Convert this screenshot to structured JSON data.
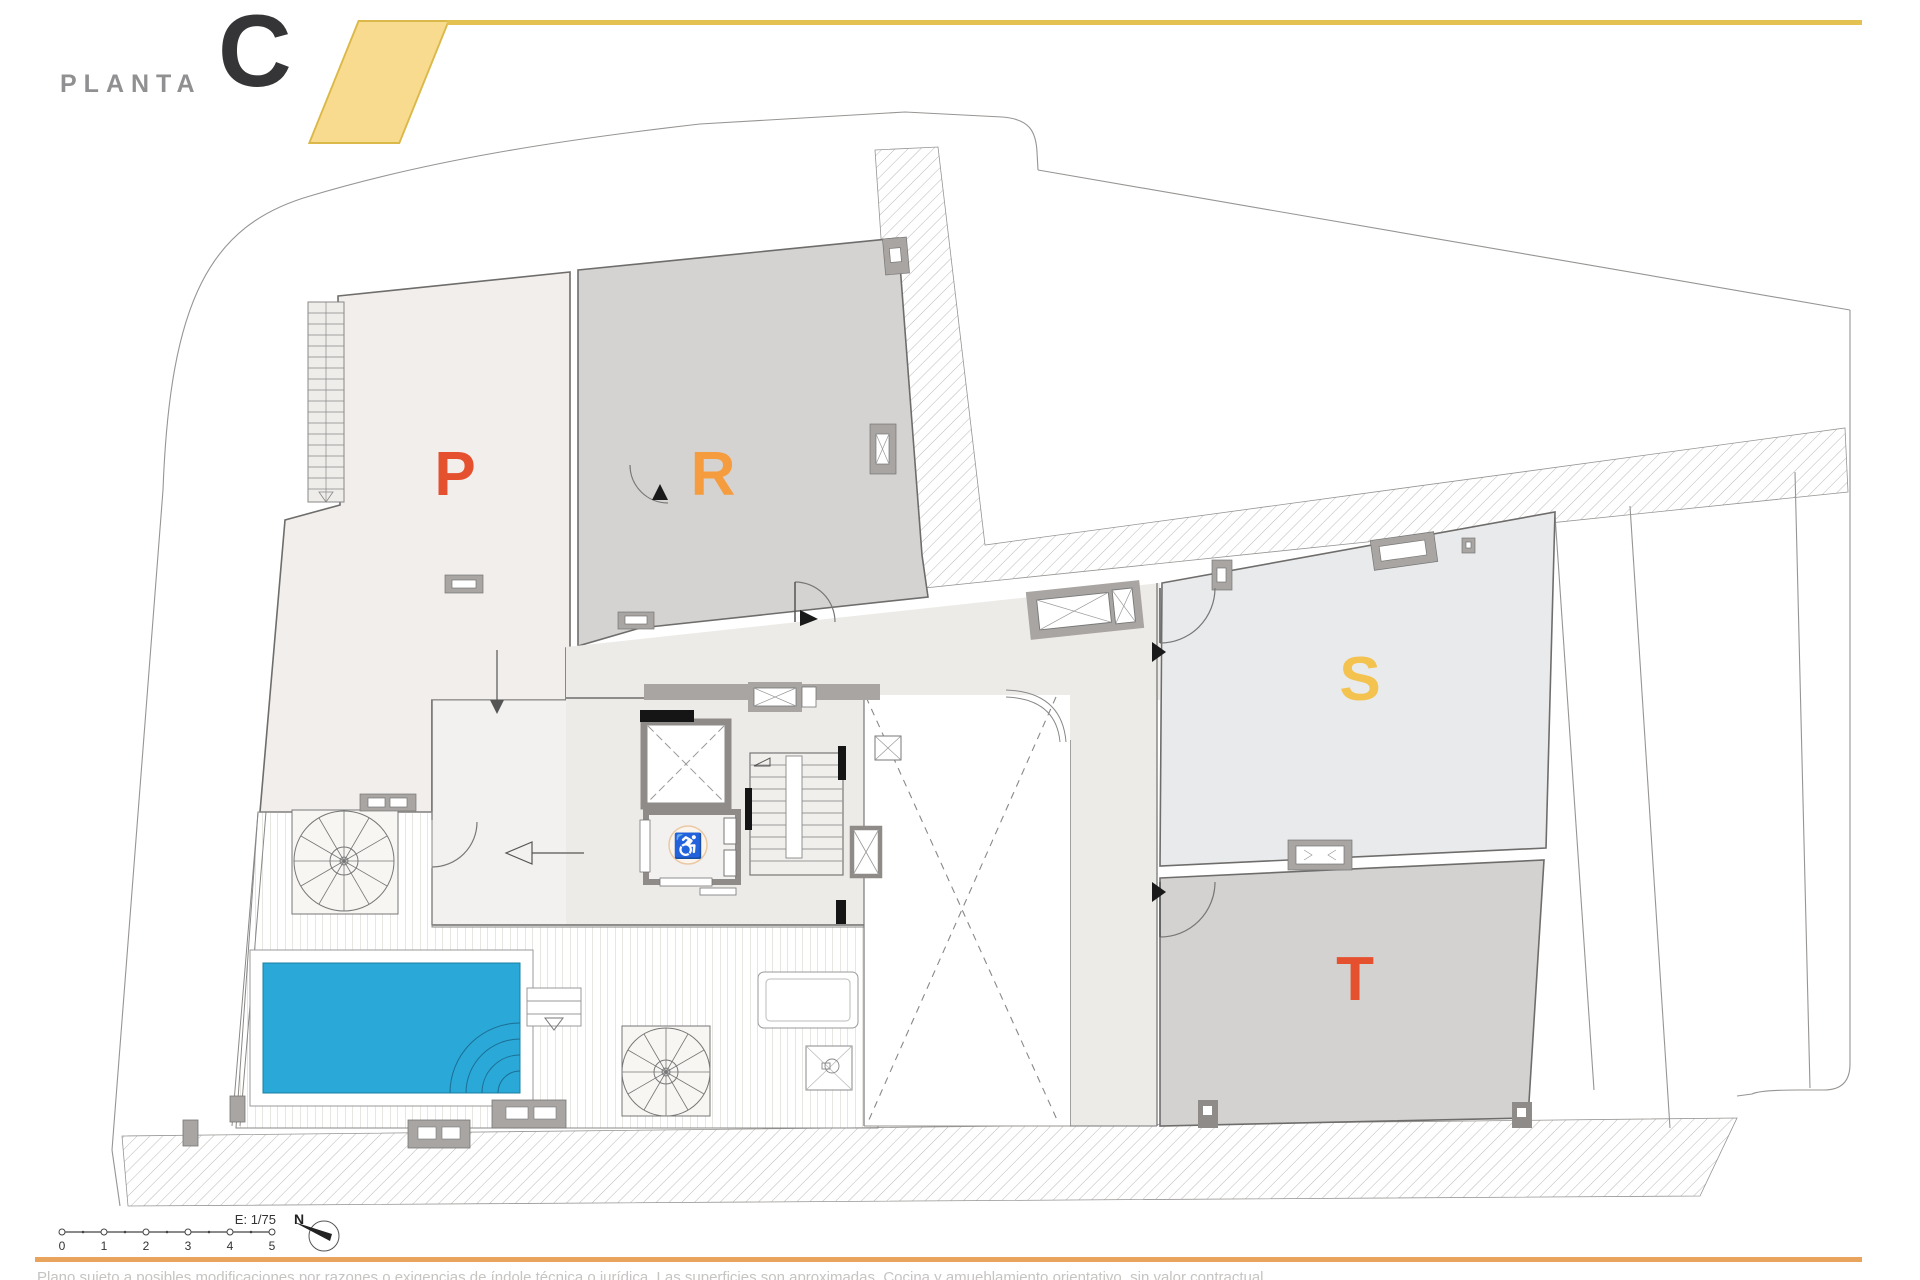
{
  "header": {
    "floor_label": "PLANTA",
    "floor_letter": "C"
  },
  "plan": {
    "units": [
      {
        "id": "P",
        "label": "P",
        "color": "#E5512F"
      },
      {
        "id": "R",
        "label": "R",
        "color": "#F59C3E"
      },
      {
        "id": "S",
        "label": "S",
        "color": "#F3C24F"
      },
      {
        "id": "T",
        "label": "T",
        "color": "#E5512F"
      }
    ],
    "icons": {
      "wheelchair": "♿"
    },
    "features": [
      "pool",
      "deck",
      "spiral-stair",
      "spiral-stair",
      "elevator",
      "stairwell",
      "lightwell",
      "shower",
      "planter"
    ]
  },
  "footer": {
    "scale_label": "E: 1/75",
    "scale_bar": {
      "ticks": [
        "0",
        "1",
        "2",
        "3",
        "4",
        "5"
      ]
    },
    "north_label": "N",
    "disclaimer": "Plano sujeto a posibles modificaciones por razones o exigencias de índole técnica o jurídica. Las superficies son aproximadas. Cocina y amueblamiento orientativo, sin valor contractual."
  },
  "colors": {
    "accent_yellow": "#F3C24F",
    "accent_orange": "#E5512F",
    "accent_orange_light": "#F59C3E",
    "pool_blue": "#2AA8D8",
    "footer_band_orange": "#E8A35C",
    "header_band_yellow": "#F8DB8E",
    "header_line_yellow": "#E3C252",
    "unit_p_fill": "#F1EEEC",
    "unit_r_fill": "#D5D3D1",
    "unit_s_fill": "#E9EAEC",
    "unit_t_fill": "#D3D2D0"
  }
}
